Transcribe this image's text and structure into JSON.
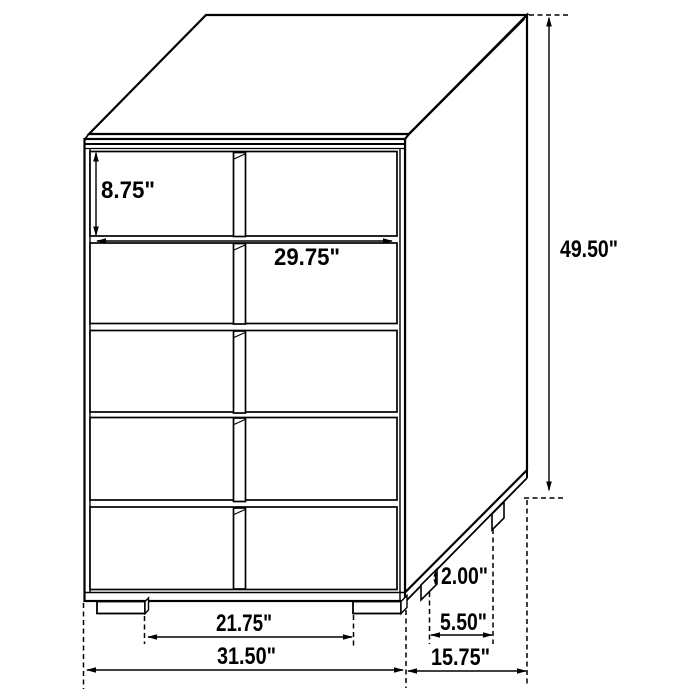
{
  "diagram": {
    "background": "#ffffff",
    "line_color": "#000000",
    "labels": {
      "drawer_height": "8.75\"",
      "drawer_width": "29.75\"",
      "overall_height": "49.50\"",
      "base_height": "2.00\"",
      "leg_depth_spacing": "5.50\"",
      "overall_depth": "15.75\"",
      "leg_width_spacing": "21.75\"",
      "overall_width": "31.50\""
    }
  }
}
